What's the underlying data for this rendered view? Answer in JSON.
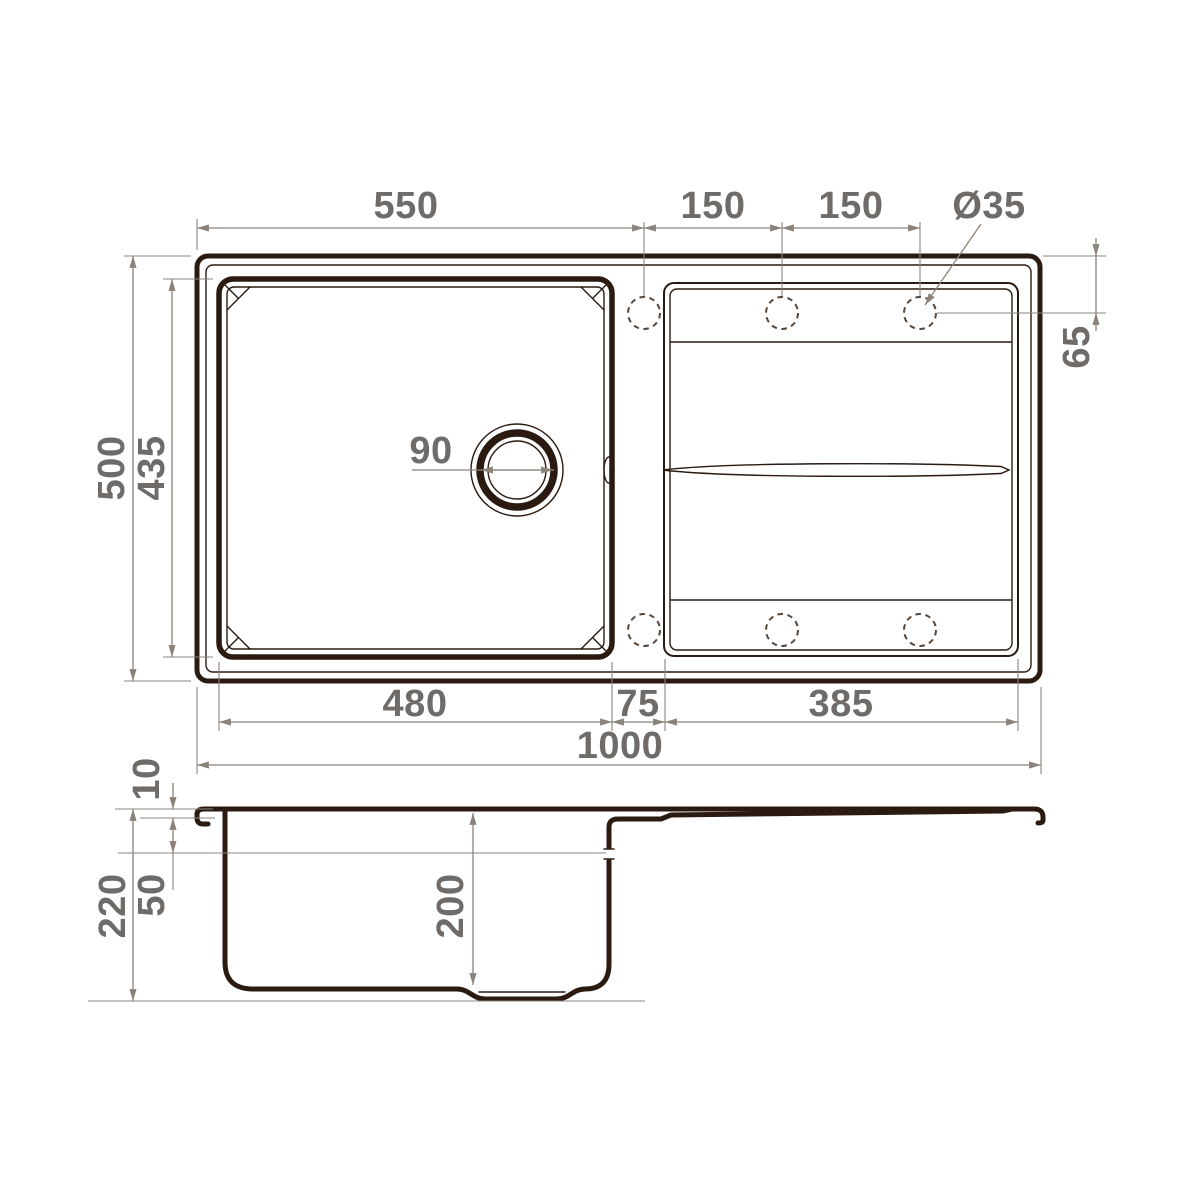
{
  "colors": {
    "background": "#ffffff",
    "drawing_line": "#2a1a10",
    "dimension_line": "#8b837a",
    "dimension_text": "#6e6b68",
    "dashed_hole": "#564639"
  },
  "top_view": {
    "dim_width_to_first_hole": "550",
    "dim_hole_spacing_1": "150",
    "dim_hole_spacing_2": "150",
    "dim_hole_diameter": "Ø35",
    "dim_hole_edge_offset": "65",
    "dim_overall_depth": "500",
    "dim_bowl_inner_depth": "435",
    "dim_drain_diameter": "90",
    "dim_bowl_inner_width": "480",
    "dim_divider_width": "75",
    "dim_drainboard_width": "385",
    "dim_overall_width": "1000"
  },
  "side_view": {
    "dim_rim_height": "10",
    "dim_overflow_offset": "50",
    "dim_overall_height": "220",
    "dim_bowl_depth": "200"
  }
}
